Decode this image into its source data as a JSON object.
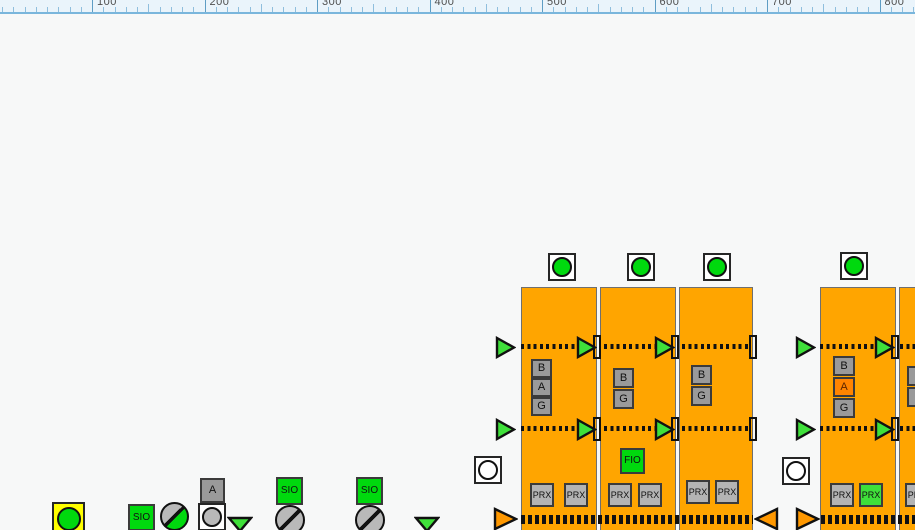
{
  "colors": {
    "ink": "#111111",
    "sqGray": "#9a9a9a",
    "prxGray": "#b4b4b4",
    "grayCircle": "#b9b9b9",
    "green": "#00d90e",
    "greenLight": "#3fe03a",
    "orange": "#ffa500",
    "orangeTri": "#ff9800",
    "alarmOrange": "#ff8400",
    "alarmText": "#5a2500",
    "yellow": "#ffff00",
    "white": "#ffffff"
  },
  "ruler": {
    "labels": [
      "100",
      "200",
      "300",
      "400",
      "500",
      "600",
      "700",
      "800"
    ],
    "start_x": 92,
    "spacing": 112.5
  },
  "symbols": [
    {
      "t": "block",
      "name": "conveyor-block-1",
      "x": 521,
      "y": 287,
      "w": 76,
      "h": 250
    },
    {
      "t": "block",
      "name": "conveyor-block-2",
      "x": 600,
      "y": 287,
      "w": 76,
      "h": 250
    },
    {
      "t": "block",
      "name": "conveyor-block-3",
      "x": 679,
      "y": 287,
      "w": 74,
      "h": 250
    },
    {
      "t": "block",
      "name": "conveyor-block-4",
      "x": 820,
      "y": 287,
      "w": 76,
      "h": 250
    },
    {
      "t": "block",
      "name": "conveyor-block-5",
      "x": 899,
      "y": 287,
      "w": 80,
      "h": 250
    },
    {
      "t": "dots",
      "name": "flow-line-upper",
      "x": 521,
      "y": 344,
      "w": 57
    },
    {
      "t": "dots",
      "name": "flow-line-upper",
      "x": 604,
      "y": 344,
      "w": 52
    },
    {
      "t": "dots",
      "name": "flow-line-upper",
      "x": 682,
      "y": 344,
      "w": 68
    },
    {
      "t": "dots",
      "name": "flow-line-upper",
      "x": 820,
      "y": 344,
      "w": 57
    },
    {
      "t": "dots",
      "name": "flow-line-upper",
      "x": 900,
      "y": 344,
      "w": 15
    },
    {
      "t": "dots",
      "name": "flow-line-middle",
      "x": 521,
      "y": 426,
      "w": 57
    },
    {
      "t": "dots",
      "name": "flow-line-middle",
      "x": 604,
      "y": 426,
      "w": 52
    },
    {
      "t": "dots",
      "name": "flow-line-middle",
      "x": 682,
      "y": 426,
      "w": 68
    },
    {
      "t": "dots",
      "name": "flow-line-middle",
      "x": 820,
      "y": 426,
      "w": 57
    },
    {
      "t": "dots",
      "name": "flow-line-middle",
      "x": 900,
      "y": 426,
      "w": 15
    },
    {
      "t": "dots",
      "name": "flow-line-bottom",
      "thick": true,
      "x": 521,
      "y": 515,
      "w": 232
    },
    {
      "t": "dots",
      "name": "flow-line-bottom",
      "thick": true,
      "x": 821,
      "y": 515,
      "w": 94
    },
    {
      "t": "vbar",
      "name": "transfer-gate-bar",
      "x": 593,
      "y": 335
    },
    {
      "t": "vbar",
      "name": "transfer-gate-bar",
      "x": 671,
      "y": 335
    },
    {
      "t": "vbar",
      "name": "transfer-gate-bar",
      "x": 749,
      "y": 335
    },
    {
      "t": "vbar",
      "name": "transfer-gate-bar",
      "x": 891,
      "y": 335
    },
    {
      "t": "vbar",
      "name": "transfer-gate-bar",
      "x": 593,
      "y": 417
    },
    {
      "t": "vbar",
      "name": "transfer-gate-bar",
      "x": 671,
      "y": 417
    },
    {
      "t": "vbar",
      "name": "transfer-gate-bar",
      "x": 749,
      "y": 417
    },
    {
      "t": "vbar",
      "name": "transfer-gate-bar",
      "x": 891,
      "y": 417
    },
    {
      "t": "tri",
      "name": "flow-arrow-right",
      "x": 495,
      "y": 336,
      "w": 21,
      "h": 23,
      "dir": "right",
      "fill": "greenLight"
    },
    {
      "t": "tri",
      "name": "flow-arrow-right",
      "x": 576,
      "y": 336,
      "w": 21,
      "h": 23,
      "dir": "right",
      "fill": "greenLight"
    },
    {
      "t": "tri",
      "name": "flow-arrow-right",
      "x": 654,
      "y": 336,
      "w": 21,
      "h": 23,
      "dir": "right",
      "fill": "greenLight"
    },
    {
      "t": "tri",
      "name": "flow-arrow-right",
      "x": 795,
      "y": 336,
      "w": 21,
      "h": 23,
      "dir": "right",
      "fill": "greenLight"
    },
    {
      "t": "tri",
      "name": "flow-arrow-right",
      "x": 874,
      "y": 336,
      "w": 21,
      "h": 23,
      "dir": "right",
      "fill": "greenLight"
    },
    {
      "t": "tri",
      "name": "flow-arrow-right",
      "x": 495,
      "y": 418,
      "w": 21,
      "h": 23,
      "dir": "right",
      "fill": "greenLight"
    },
    {
      "t": "tri",
      "name": "flow-arrow-right",
      "x": 576,
      "y": 418,
      "w": 21,
      "h": 23,
      "dir": "right",
      "fill": "greenLight"
    },
    {
      "t": "tri",
      "name": "flow-arrow-right",
      "x": 654,
      "y": 418,
      "w": 21,
      "h": 23,
      "dir": "right",
      "fill": "greenLight"
    },
    {
      "t": "tri",
      "name": "flow-arrow-right",
      "x": 795,
      "y": 418,
      "w": 21,
      "h": 23,
      "dir": "right",
      "fill": "greenLight"
    },
    {
      "t": "tri",
      "name": "flow-arrow-right",
      "x": 874,
      "y": 418,
      "w": 21,
      "h": 23,
      "dir": "right",
      "fill": "greenLight"
    },
    {
      "t": "tri",
      "name": "return-arrow-right",
      "x": 493,
      "y": 507,
      "w": 25,
      "h": 24,
      "dir": "right",
      "fill": "orangeTri"
    },
    {
      "t": "tri",
      "name": "return-arrow-left",
      "x": 754,
      "y": 507,
      "w": 25,
      "h": 24,
      "dir": "left",
      "fill": "orangeTri"
    },
    {
      "t": "tri",
      "name": "return-arrow-right",
      "x": 795,
      "y": 507,
      "w": 25,
      "h": 24,
      "dir": "right",
      "fill": "orangeTri"
    },
    {
      "t": "tri",
      "name": "divert-arrow-down",
      "x": 227,
      "y": 515,
      "w": 26,
      "h": 18,
      "dir": "down",
      "fill": "greenLight"
    },
    {
      "t": "tri",
      "name": "divert-arrow-down",
      "x": 414,
      "y": 515,
      "w": 26,
      "h": 18,
      "dir": "down",
      "fill": "greenLight"
    },
    {
      "t": "led",
      "name": "run-status-indicator",
      "x": 548,
      "y": 253,
      "d": 28,
      "box": "white",
      "circle": "green",
      "cd": 20
    },
    {
      "t": "led",
      "name": "run-status-indicator",
      "x": 627,
      "y": 253,
      "d": 28,
      "box": "white",
      "circle": "green",
      "cd": 20
    },
    {
      "t": "led",
      "name": "run-status-indicator",
      "x": 703,
      "y": 253,
      "d": 28,
      "box": "white",
      "circle": "green",
      "cd": 20
    },
    {
      "t": "led",
      "name": "run-status-indicator",
      "x": 840,
      "y": 252,
      "d": 28,
      "box": "white",
      "circle": "green",
      "cd": 20
    },
    {
      "t": "led",
      "name": "idle-status-indicator",
      "x": 474,
      "y": 456,
      "d": 28,
      "box": "white",
      "circle": "white",
      "cd": 20
    },
    {
      "t": "led",
      "name": "idle-status-indicator",
      "x": 782,
      "y": 457,
      "d": 28,
      "box": "white",
      "circle": "white",
      "cd": 20
    },
    {
      "t": "led",
      "name": "alarm-lamp-yellow",
      "x": 52,
      "y": 502,
      "d": 33,
      "box": "yellow",
      "circle": "green",
      "cd": 24
    },
    {
      "t": "led",
      "name": "mode-lamp-gray",
      "x": 198,
      "y": 503,
      "d": 28,
      "box": "white",
      "circle": "grayCircle",
      "cd": 20
    },
    {
      "t": "sq",
      "name": "sensor-tag-b",
      "x": 531,
      "y": 359,
      "w": 21,
      "h": 19,
      "label": "B",
      "bg": "sqGray",
      "fs": 11
    },
    {
      "t": "sq",
      "name": "sensor-tag-a",
      "x": 531,
      "y": 378,
      "w": 21,
      "h": 19,
      "label": "A",
      "bg": "sqGray",
      "fs": 11
    },
    {
      "t": "sq",
      "name": "sensor-tag-g",
      "x": 531,
      "y": 397,
      "w": 21,
      "h": 19,
      "label": "G",
      "bg": "sqGray",
      "fs": 11
    },
    {
      "t": "sq",
      "name": "sensor-tag-b",
      "x": 613,
      "y": 368,
      "w": 21,
      "h": 20,
      "label": "B",
      "bg": "sqGray",
      "fs": 11
    },
    {
      "t": "sq",
      "name": "sensor-tag-g",
      "x": 613,
      "y": 389,
      "w": 21,
      "h": 20,
      "label": "G",
      "bg": "sqGray",
      "fs": 11
    },
    {
      "t": "sq",
      "name": "sensor-tag-b",
      "x": 691,
      "y": 365,
      "w": 21,
      "h": 20,
      "label": "B",
      "bg": "sqGray",
      "fs": 11
    },
    {
      "t": "sq",
      "name": "sensor-tag-g",
      "x": 691,
      "y": 386,
      "w": 21,
      "h": 20,
      "label": "G",
      "bg": "sqGray",
      "fs": 11
    },
    {
      "t": "sq",
      "name": "sensor-tag-b",
      "x": 833,
      "y": 356,
      "w": 22,
      "h": 20,
      "label": "B",
      "bg": "sqGray",
      "fs": 11
    },
    {
      "t": "sq",
      "name": "sensor-tag-a-alarm",
      "x": 833,
      "y": 377,
      "w": 22,
      "h": 20,
      "label": "A",
      "bg": "alarmOrange",
      "fg": "alarmText",
      "fs": 11
    },
    {
      "t": "sq",
      "name": "sensor-tag-g",
      "x": 833,
      "y": 398,
      "w": 22,
      "h": 20,
      "label": "G",
      "bg": "sqGray",
      "fs": 11
    },
    {
      "t": "sq",
      "name": "sensor-tag-partial",
      "x": 907,
      "y": 366,
      "w": 12,
      "h": 20,
      "label": "",
      "bg": "sqGray",
      "fs": 11
    },
    {
      "t": "sq",
      "name": "sensor-tag-partial",
      "x": 907,
      "y": 387,
      "w": 12,
      "h": 20,
      "label": "",
      "bg": "sqGray",
      "fs": 11
    },
    {
      "t": "sq",
      "name": "fio-module",
      "x": 620,
      "y": 448,
      "w": 25,
      "h": 26,
      "label": "FIO",
      "bg": "green",
      "fs": 10
    },
    {
      "t": "sq",
      "name": "prx-sensor",
      "x": 530,
      "y": 483,
      "w": 24,
      "h": 24,
      "label": "PRX",
      "bg": "prxGray",
      "fs": 9
    },
    {
      "t": "sq",
      "name": "prx-sensor",
      "x": 564,
      "y": 483,
      "w": 24,
      "h": 24,
      "label": "PRX",
      "bg": "prxGray",
      "fs": 9
    },
    {
      "t": "sq",
      "name": "prx-sensor",
      "x": 608,
      "y": 483,
      "w": 24,
      "h": 24,
      "label": "PRX",
      "bg": "prxGray",
      "fs": 9
    },
    {
      "t": "sq",
      "name": "prx-sensor",
      "x": 638,
      "y": 483,
      "w": 24,
      "h": 24,
      "label": "PRX",
      "bg": "prxGray",
      "fs": 9
    },
    {
      "t": "sq",
      "name": "prx-sensor",
      "x": 686,
      "y": 480,
      "w": 24,
      "h": 24,
      "label": "PRX",
      "bg": "prxGray",
      "fs": 9
    },
    {
      "t": "sq",
      "name": "prx-sensor",
      "x": 715,
      "y": 480,
      "w": 24,
      "h": 24,
      "label": "PRX",
      "bg": "prxGray",
      "fs": 9
    },
    {
      "t": "sq",
      "name": "prx-sensor",
      "x": 830,
      "y": 483,
      "w": 24,
      "h": 24,
      "label": "PRX",
      "bg": "prxGray",
      "fs": 9
    },
    {
      "t": "sq",
      "name": "prx-sensor-active",
      "x": 859,
      "y": 483,
      "w": 24,
      "h": 24,
      "label": "PRX",
      "bg": "greenLight",
      "fs": 9
    },
    {
      "t": "sq",
      "name": "prx-sensor",
      "x": 905,
      "y": 483,
      "w": 24,
      "h": 24,
      "label": "PRX",
      "bg": "prxGray",
      "fs": 9
    },
    {
      "t": "sq",
      "name": "sio-module",
      "x": 128,
      "y": 504,
      "w": 27,
      "h": 27,
      "label": "SIO",
      "bg": "green",
      "fs": 10
    },
    {
      "t": "sq",
      "name": "sio-module",
      "x": 276,
      "y": 477,
      "w": 27,
      "h": 28,
      "label": "SIO",
      "bg": "green",
      "fs": 10
    },
    {
      "t": "sq",
      "name": "sio-module",
      "x": 356,
      "y": 477,
      "w": 27,
      "h": 28,
      "label": "SIO",
      "bg": "green",
      "fs": 10
    },
    {
      "t": "sq",
      "name": "tag-a-gray",
      "x": 200,
      "y": 478,
      "w": 25,
      "h": 25,
      "label": "A",
      "bg": "sqGray",
      "fs": 11
    },
    {
      "t": "splitc",
      "name": "valve-indicator-half-green",
      "x": 160,
      "y": 502,
      "d": 29,
      "a": "grayCircle",
      "b": "green"
    },
    {
      "t": "splitc",
      "name": "valve-indicator-gray",
      "x": 275,
      "y": 505,
      "d": 30,
      "a": "grayCircle",
      "b": "grayCircle"
    },
    {
      "t": "splitc",
      "name": "valve-indicator-gray",
      "x": 355,
      "y": 505,
      "d": 30,
      "a": "grayCircle",
      "b": "grayCircle"
    }
  ]
}
